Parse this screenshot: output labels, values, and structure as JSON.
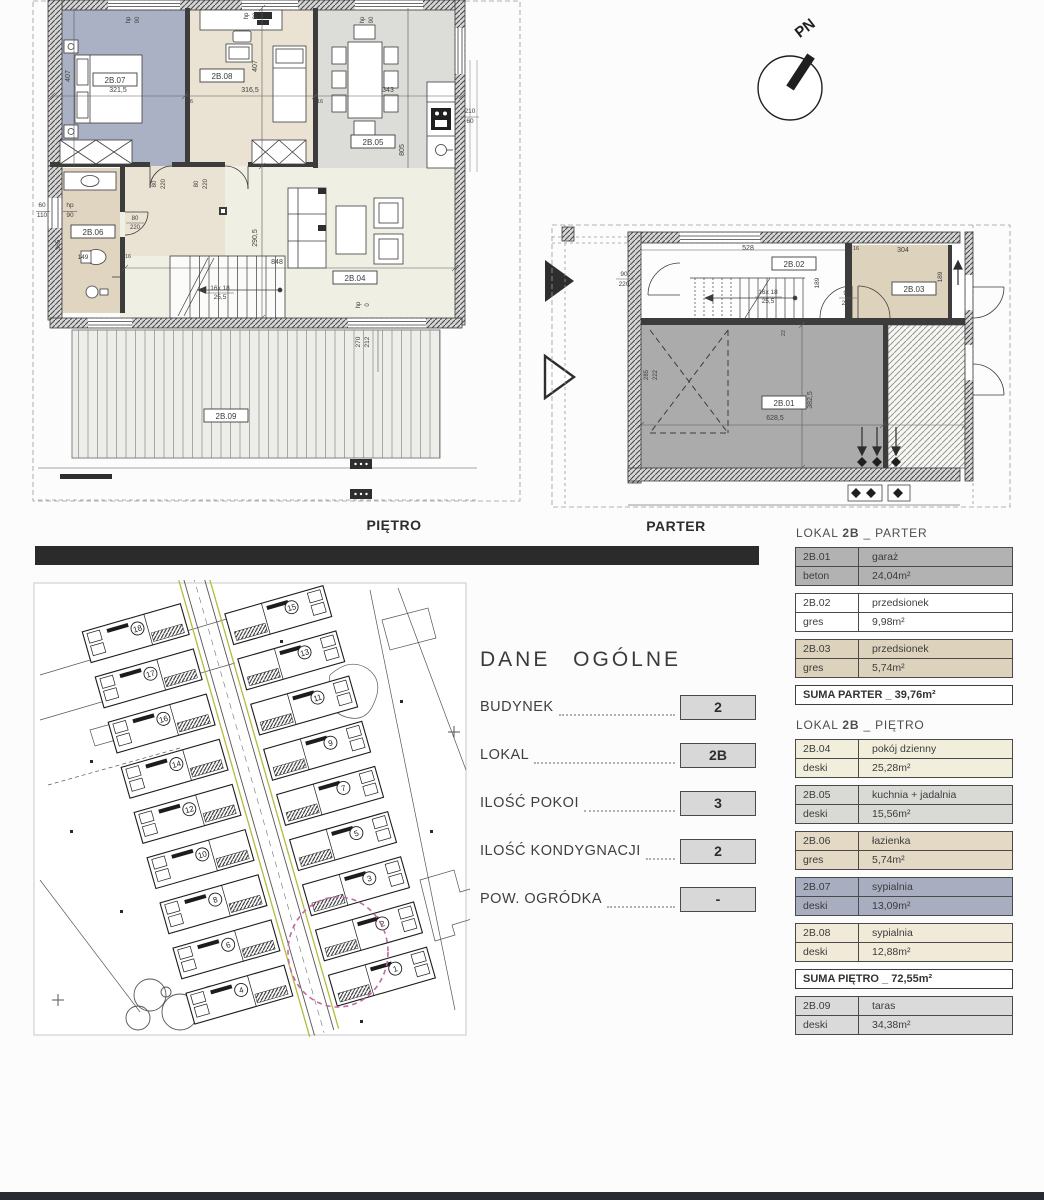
{
  "captions": {
    "pietro": "PIĘTRO",
    "parter": "PARTER"
  },
  "compass": {
    "label": "PN"
  },
  "dane_ogolne": {
    "title": "DANE OGÓLNE",
    "rows": [
      {
        "label": "BUDYNEK",
        "value": "2"
      },
      {
        "label": "LOKAL",
        "value": "2B"
      },
      {
        "label": "ILOŚĆ POKOI",
        "value": "3"
      },
      {
        "label": "ILOŚĆ KONDYGNACJI",
        "value": "2"
      },
      {
        "label": "POW. OGRÓDKA",
        "value": "-"
      }
    ]
  },
  "legend": {
    "sections": [
      {
        "header_pre": "LOKAL ",
        "header_bold": "2B",
        "header_post": " _ PARTER",
        "rooms": [
          {
            "id": "2B.01",
            "name": "garaż",
            "material": "beton",
            "area": "24,04m²",
            "bg": "#b2b2b2"
          },
          {
            "id": "2B.02",
            "name": "przedsionek",
            "material": "gres",
            "area": "9,98m²",
            "bg": "#ffffff"
          },
          {
            "id": "2B.03",
            "name": "przedsionek",
            "material": "gres",
            "area": "5,74m²",
            "bg": "#ddd2bc"
          }
        ],
        "suma": "SUMA PARTER _ 39,76m²",
        "extra_rooms": []
      },
      {
        "header_pre": "LOKAL ",
        "header_bold": "2B",
        "header_post": " _ PIĘTRO",
        "rooms": [
          {
            "id": "2B.04",
            "name": "pokój dzienny",
            "material": "deski",
            "area": "25,28m²",
            "bg": "#f1efdc"
          },
          {
            "id": "2B.05",
            "name": "kuchnia + jadalnia",
            "material": "deski",
            "area": "15,56m²",
            "bg": "#d9dad6"
          },
          {
            "id": "2B.06",
            "name": "łazienka",
            "material": "gres",
            "area": "5,74m²",
            "bg": "#e3d9c5"
          },
          {
            "id": "2B.07",
            "name": "sypialnia",
            "material": "deski",
            "area": "13,09m²",
            "bg": "#a8adc0"
          },
          {
            "id": "2B.08",
            "name": "sypialnia",
            "material": "deski",
            "area": "12,88m²",
            "bg": "#f1ead8"
          }
        ],
        "suma": "SUMA PIĘTRO _ 72,55m²",
        "extra_rooms": [
          {
            "id": "2B.09",
            "name": "taras",
            "material": "deski",
            "area": "34,38m²",
            "bg": "#dadada"
          }
        ]
      }
    ]
  },
  "plans": {
    "pietro": {
      "room_boxes": [
        {
          "t": "2B.07",
          "x": 85,
          "y": 80
        },
        {
          "t": "2B.08",
          "x": 192,
          "y": 76
        },
        {
          "t": "2B.05",
          "x": 343,
          "y": 142
        },
        {
          "t": "2B.06",
          "x": 63,
          "y": 232
        },
        {
          "t": "2B.04",
          "x": 325,
          "y": 278
        },
        {
          "t": "2B.09",
          "x": 196,
          "y": 416
        }
      ],
      "dims": [
        {
          "t": "321,5",
          "x": 88,
          "y": 92
        },
        {
          "t": "316,5",
          "x": 220,
          "y": 92
        },
        {
          "t": "343",
          "x": 358,
          "y": 92
        },
        {
          "t": "407",
          "x": 40,
          "y": 76,
          "r": 1
        },
        {
          "t": "407",
          "x": 227,
          "y": 66,
          "r": 1
        },
        {
          "t": "290,5",
          "x": 227,
          "y": 238,
          "r": 1
        },
        {
          "t": "805",
          "x": 374,
          "y": 150,
          "r": 1
        },
        {
          "t": "848",
          "x": 247,
          "y": 264
        },
        {
          "t": "16x 18",
          "x": 190,
          "y": 290,
          "s": 6.5
        },
        {
          "t": "25,5",
          "x": 190,
          "y": 299,
          "s": 6.5
        },
        {
          "t": "80",
          "x": 126,
          "y": 184,
          "r": 1,
          "s": 6
        },
        {
          "t": "220",
          "x": 135,
          "y": 184,
          "r": 1,
          "s": 6
        },
        {
          "t": "80",
          "x": 168,
          "y": 184,
          "r": 1,
          "s": 6
        },
        {
          "t": "220",
          "x": 177,
          "y": 184,
          "r": 1,
          "s": 6
        },
        {
          "t": "80",
          "x": 105,
          "y": 220,
          "s": 6
        },
        {
          "t": "220",
          "x": 105,
          "y": 229,
          "s": 6
        },
        {
          "t": "hp",
          "x": 100,
          "y": 20,
          "r": 1,
          "s": 6
        },
        {
          "t": "90",
          "x": 109,
          "y": 20,
          "r": 1,
          "s": 6
        },
        {
          "t": "hp",
          "x": 218,
          "y": 16,
          "r": 1,
          "s": 6
        },
        {
          "t": "90",
          "x": 227,
          "y": 16,
          "r": 1,
          "s": 6
        },
        {
          "t": "hp",
          "x": 334,
          "y": 20,
          "r": 1,
          "s": 6
        },
        {
          "t": "90",
          "x": 343,
          "y": 20,
          "r": 1,
          "s": 6
        },
        {
          "t": "60",
          "x": 12,
          "y": 207,
          "s": 6.5
        },
        {
          "t": "110",
          "x": 12,
          "y": 217,
          "s": 6.5
        },
        {
          "t": "hp",
          "x": 40,
          "y": 207,
          "s": 6.5
        },
        {
          "t": "90",
          "x": 40,
          "y": 217,
          "s": 6.5
        },
        {
          "t": "210",
          "x": 440,
          "y": 113,
          "s": 6.5
        },
        {
          "t": "60",
          "x": 440,
          "y": 123,
          "s": 6.5
        },
        {
          "t": "365",
          "x": 30,
          "y": 245,
          "r": 1,
          "s": 6.5
        },
        {
          "t": "149",
          "x": 53,
          "y": 259,
          "s": 6.5
        },
        {
          "t": "270",
          "x": 330,
          "y": 342,
          "r": 1,
          "s": 6.5
        },
        {
          "t": "212",
          "x": 339,
          "y": 342,
          "r": 1,
          "s": 6.5
        },
        {
          "t": "16",
          "x": 160,
          "y": 103,
          "s": 5.5
        },
        {
          "t": "16",
          "x": 290,
          "y": 103,
          "s": 5.5
        },
        {
          "t": "hp",
          "x": 330,
          "y": 305,
          "r": 1,
          "s": 6
        },
        {
          "t": "0",
          "x": 339,
          "y": 305,
          "r": 1,
          "s": 6
        },
        {
          "t": "16",
          "x": 98,
          "y": 258,
          "s": 5.5
        }
      ]
    },
    "parter": {
      "room_boxes": [
        {
          "t": "2B.02",
          "x": 254,
          "y": 49
        },
        {
          "t": "2B.03",
          "x": 374,
          "y": 74
        },
        {
          "t": "2B.01",
          "x": 244,
          "y": 188
        }
      ],
      "dims": [
        {
          "t": "528",
          "x": 208,
          "y": 35
        },
        {
          "t": "304",
          "x": 363,
          "y": 37
        },
        {
          "t": "16",
          "x": 316,
          "y": 35,
          "s": 5.5
        },
        {
          "t": "189",
          "x": 279,
          "y": 68,
          "r": 1,
          "s": 6.5
        },
        {
          "t": "189",
          "x": 402,
          "y": 62,
          "r": 1,
          "s": 6.5
        },
        {
          "t": "16x 18",
          "x": 228,
          "y": 79,
          "s": 6.5
        },
        {
          "t": "25,5",
          "x": 228,
          "y": 88,
          "s": 6.5
        },
        {
          "t": "90",
          "x": 84,
          "y": 61,
          "s": 6.5
        },
        {
          "t": "220",
          "x": 84,
          "y": 71,
          "s": 6.5
        },
        {
          "t": "90",
          "x": 307,
          "y": 80,
          "s": 6.5
        },
        {
          "t": "220",
          "x": 307,
          "y": 90,
          "s": 6.5
        },
        {
          "t": "628,5",
          "x": 235,
          "y": 205
        },
        {
          "t": "382,5",
          "x": 272,
          "y": 185,
          "r": 1
        },
        {
          "t": "285",
          "x": 108,
          "y": 160,
          "r": 1,
          "s": 6
        },
        {
          "t": "222",
          "x": 117,
          "y": 160,
          "r": 1,
          "s": 6
        },
        {
          "t": "22",
          "x": 245,
          "y": 118,
          "r": 1,
          "s": 5.5
        }
      ]
    }
  },
  "site_plan": {
    "houses_left": [
      "18",
      "17",
      "16",
      "14",
      "12",
      "10",
      "8",
      "6",
      "4"
    ],
    "houses_right": [
      "15",
      "13",
      "11",
      "9",
      "7",
      "5",
      "3",
      "2",
      "1"
    ],
    "highlight_color": "#c468a4",
    "road_color": "#b3ba3c"
  }
}
